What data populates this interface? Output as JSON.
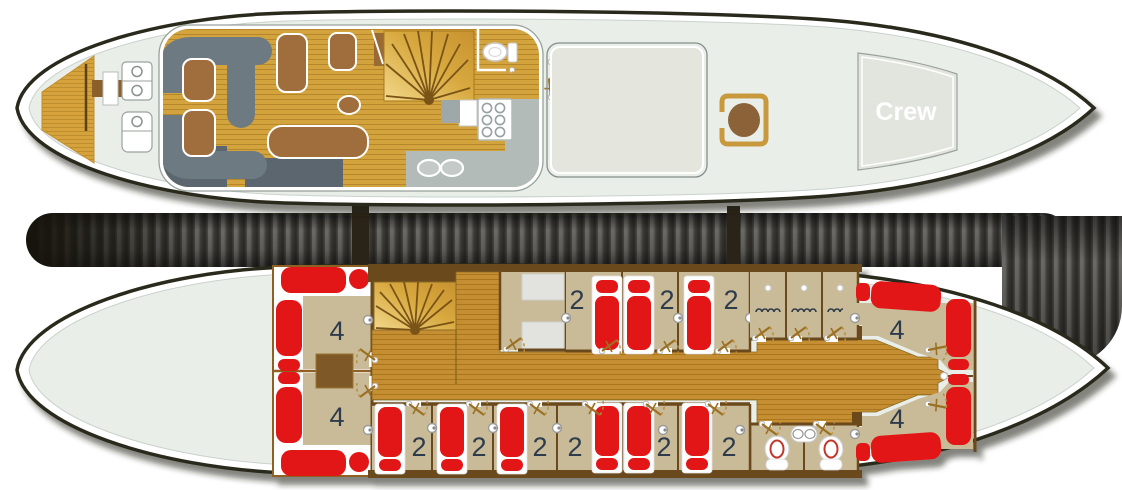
{
  "title": "motor-sailer-deck-plans",
  "upper_deck": {
    "crew_label": "Crew",
    "areas": [
      "swim-platform",
      "aft-lounge",
      "salon-galley",
      "wc",
      "staircase",
      "skylight",
      "crew-quarters"
    ]
  },
  "lower_deck": {
    "aft_quad_cabins": [
      {
        "label": "4"
      },
      {
        "label": "4"
      }
    ],
    "upper_row_double_cabins": [
      {
        "label": "2"
      },
      {
        "label": "2"
      },
      {
        "label": "2"
      }
    ],
    "lower_row_double_cabins": [
      {
        "label": "2"
      },
      {
        "label": "2"
      },
      {
        "label": "2"
      },
      {
        "label": "2"
      },
      {
        "label": "2"
      },
      {
        "label": "2"
      }
    ],
    "bow_quad_cabins": [
      {
        "label": "4"
      },
      {
        "label": "4"
      }
    ]
  },
  "icons": {
    "door-swing-icon": "hinge dot + angled leaf + dashed arc",
    "wall-lamp-icon": "double circle",
    "toilet-icon": "oval bowl with tank/base",
    "shower-icon": "scalloped wavy line",
    "light-icon": "small white dot",
    "stove-icon": "six burner circles",
    "sink-icon": "oval basins",
    "staircase-icon": "fan of radial steps",
    "ladder-icon": "rail with white step"
  },
  "colors": {
    "hull_fill": "#EAEEE9",
    "hull_outline": "#2B2A1E",
    "deck_wood": "#D3A33E",
    "corridor_wood": "#C68E30",
    "cabin_floor": "#C9BB97",
    "wall_brown": "#6B4A1D",
    "bed_red": "#E21617",
    "sofa_gray": "#6E7A82",
    "furniture_brown": "#A06E3C",
    "counter_gray": "#B3BBB8",
    "label_color": "#2F3B4C",
    "accent_gold": "#C89A3C",
    "skylight_fill": "#E4E6DE"
  }
}
